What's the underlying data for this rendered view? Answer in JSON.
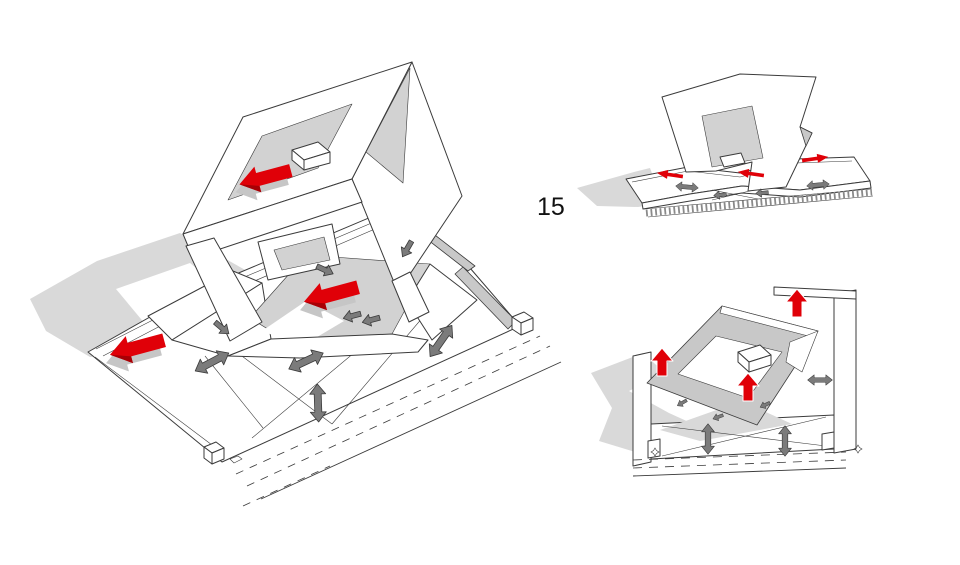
{
  "figure": {
    "number": "15"
  },
  "colors": {
    "line": "#3b3b3b",
    "accent_red": "#e00008",
    "accent_red_dark": "#a80005",
    "arrow_gray": "#7b7b7b",
    "shadow_gray": "#d9d9d9",
    "floor_gray": "#d2d2d2",
    "wall_gray": "#c8c8c8",
    "hatch_gray": "#8a8a8a"
  },
  "views": [
    {
      "id": "main-axonometric"
    },
    {
      "id": "upper-right-axonometric"
    },
    {
      "id": "lower-right-axonometric"
    }
  ]
}
